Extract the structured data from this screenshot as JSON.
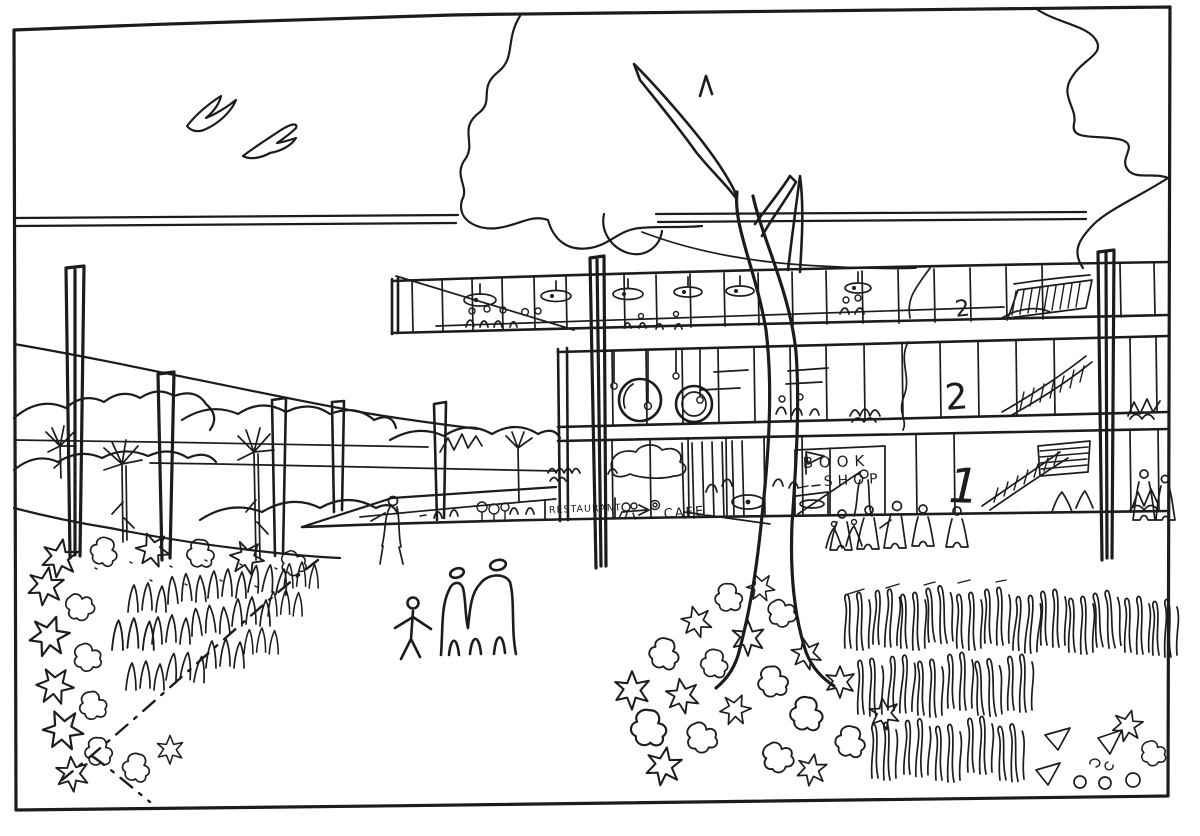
{
  "scene": {
    "kind": "hand-drawn architectural perspective sketch",
    "ink_color": "#1c1c1c",
    "paper_color": "#ffffff"
  },
  "signage": {
    "book_shop_line1": "BOOK",
    "book_shop_line2": "SHOP",
    "restaurant": "RESTAURANT",
    "cafe": "CAFE"
  },
  "floor_numbers": {
    "upper": "2",
    "middle": "2",
    "ground": "1"
  }
}
